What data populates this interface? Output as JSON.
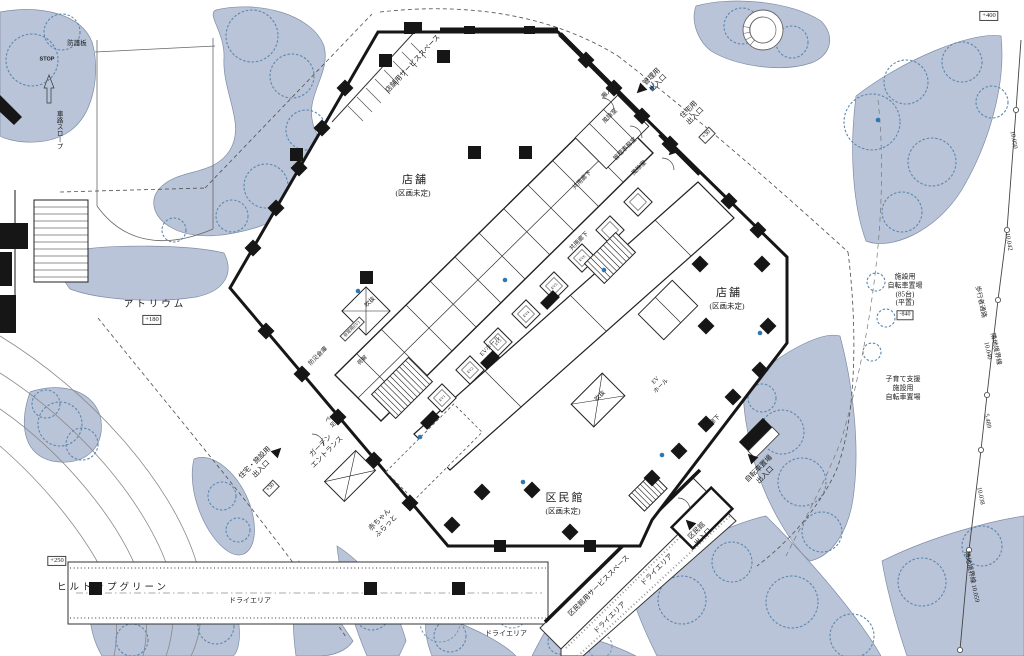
{
  "colors": {
    "landscape_fill": "#b9c4d8",
    "tree_stroke": "#5d87ad",
    "wall": "#161616",
    "line": "#555555",
    "marker_blue": "#2e77b5"
  },
  "plan": {
    "areas": {
      "store": "店舗",
      "undecided": "(区画未定)",
      "kuminkan": "区民館",
      "atrium": "アトリウム",
      "hilltop_green": "ヒルトップグリーン"
    },
    "levels": {
      "atrium": "+180",
      "hilltop": "+250",
      "site_ne": "+400",
      "entrance": "+30",
      "bicycle": "-840"
    },
    "entrances": {
      "management": "管理用\n出入口",
      "residential": "住宅用\n出入口",
      "residential_facility": "住宅・施設用\n出入口",
      "garden": "ガーデン\nエントランス",
      "kuminkan": "区民館\n出入口",
      "bicycle": "自転車置場\n出入口",
      "loading": "搬入口"
    },
    "rooms": {
      "windbreak": "風除室",
      "management_office": "管理事務室",
      "common_corridor": "共用廊下",
      "ev_hall": "EVホール",
      "ev_hall_2l": "EV\nホール",
      "corridor": "廊下",
      "void": "吹抜",
      "disaster_storage": "防災倉庫",
      "unloading": "荷解",
      "emergency_ev": "非常用EV1",
      "pet_wash": "ペット\n足洗場",
      "baby_rest": "赤ちゃん\nふらっと"
    },
    "service": {
      "store_service": "店舗用サービススペース",
      "kuminkan_service": "区民館用サービススペース",
      "dry_area": "ドライエリア"
    },
    "bicycle_parking": {
      "facility": "施設用\n自転車置場\n(85台)\n(平置)",
      "childcare": "子育て支援\n施設用\n自転車置場"
    },
    "site": {
      "walkway": "歩行者通路",
      "boundary_10040": "隣地境界線 10.040",
      "boundary_10059": "隣地境界線 10.059",
      "dim_10050": "10.050",
      "dim_10042": "10.042",
      "dim_5489": "5.489",
      "dim_10038": "10.038",
      "guard_board": "防護板",
      "stop": "STOP",
      "ramp": "車路スロープ"
    },
    "ev": [
      "EV1",
      "EV2",
      "EV3",
      "EV4",
      "EV5",
      "EV6"
    ]
  }
}
